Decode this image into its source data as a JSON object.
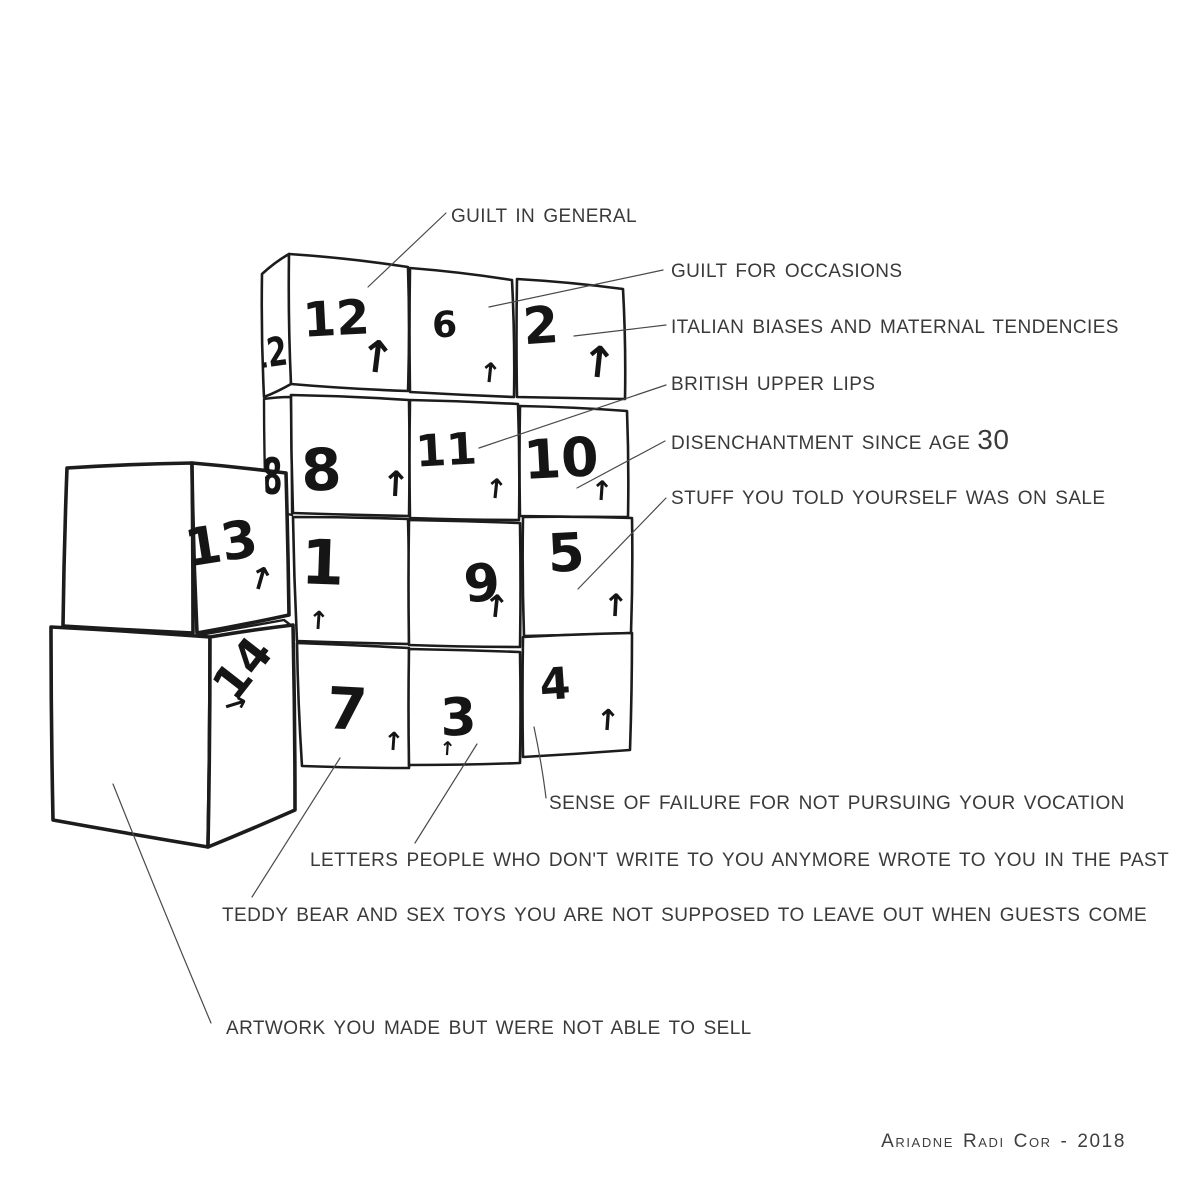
{
  "artwork": {
    "description": "hand-drawn stack of numbered moving boxes with annotation labels",
    "year_signature": "Ariadne Radi Cor - 2018"
  },
  "boxes": {
    "box12": {
      "number": "12",
      "arrow": "↑"
    },
    "box6": {
      "number": "6",
      "arrow": "↑"
    },
    "box2": {
      "number": "2",
      "arrow": "↑"
    },
    "box8": {
      "number": "8",
      "arrow": "↑"
    },
    "box11": {
      "number": "11",
      "arrow": "↑"
    },
    "box10": {
      "number": "10",
      "arrow": "↑"
    },
    "box1": {
      "number": "1",
      "arrow": "↑"
    },
    "box9": {
      "number": "9",
      "arrow": "↑"
    },
    "box5": {
      "number": "5",
      "arrow": "↑"
    },
    "box7": {
      "number": "7",
      "arrow": "↑"
    },
    "box3": {
      "number": "3",
      "arrow": "↑"
    },
    "box4": {
      "number": "4",
      "arrow": "↑"
    },
    "box13": {
      "number": "13",
      "arrow": "↑"
    },
    "box14": {
      "number": "14",
      "arrow": "→"
    },
    "box12_side": {
      "number": "12"
    },
    "box8_side": {
      "number": "8"
    }
  },
  "annotations": [
    {
      "text": "GUILT IN GENERAL",
      "target": "box12"
    },
    {
      "text": "GUILT FOR OCCASIONS",
      "target": "box6"
    },
    {
      "text": "ITALIAN BIASES AND MATERNAL TENDENCIES",
      "target": "box2"
    },
    {
      "text": "BRITISH UPPER LIPS",
      "target": "box11"
    },
    {
      "text": "DISENCHANTMENT SINCE AGE",
      "suffix": "30",
      "target": "box10"
    },
    {
      "text": "STUFF YOU TOLD YOURSELF WAS ON SALE",
      "target": "box5"
    },
    {
      "text": "SENSE OF FAILURE FOR NOT PURSUING YOUR VOCATION",
      "target": "box4"
    },
    {
      "text": "LETTERS PEOPLE WHO DON'T WRITE TO YOU ANYMORE WROTE TO YOU IN THE PAST",
      "target": "box3"
    },
    {
      "text": "TEDDY BEAR AND SEX TOYS YOU ARE NOT SUPPOSED TO LEAVE OUT WHEN GUESTS COME",
      "target": "box7"
    },
    {
      "text": "ARTWORK YOU MADE BUT WERE NOT ABLE TO SELL",
      "target": "box14"
    }
  ],
  "signature": {
    "text": "Ariadne Radi Cor - 2018"
  },
  "colors": {
    "background": "#ffffff",
    "ink": "#1c1c1c",
    "label_text": "#3a3a3a",
    "leader_line": "#4a4a4a"
  }
}
